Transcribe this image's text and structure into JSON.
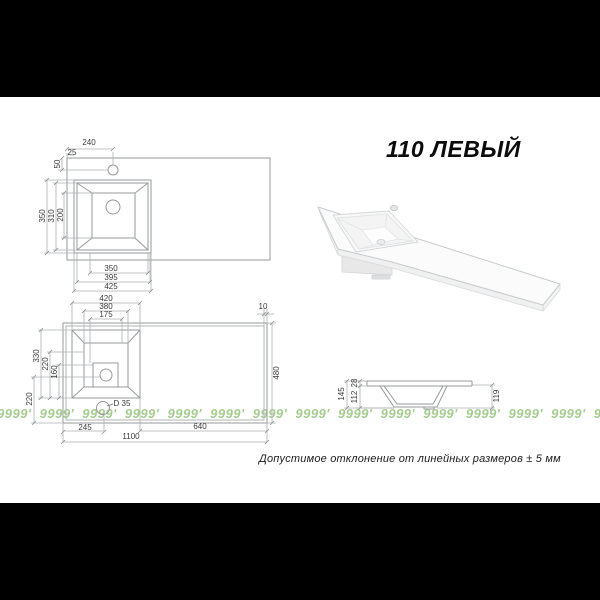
{
  "title": "110 ЛЕВЫЙ",
  "note": "Допустимое отклонение от линейных размеров ± 5 мм",
  "watermark": {
    "text": "9999' 9999' 9999' 9999' 9999' 9999' 9999' 9999' 9999' 9999' 9999' 9999' 9999' 9999' 9999' 9999' 9999' 9999'",
    "color": "#a5cc90"
  },
  "colors": {
    "background_bars": "#000000",
    "canvas": "#ffffff",
    "drawing_line": "#97999b",
    "dimension_text": "#3a3a3a"
  },
  "top_view": {
    "dims": {
      "d240": "240",
      "d25": "25",
      "d50": "50",
      "d350": "350",
      "d310": "310",
      "d200": "200",
      "db350": "350",
      "db395": "395",
      "db425": "425"
    }
  },
  "bottom_view": {
    "dims": {
      "d420": "420",
      "d380": "380",
      "d175": "175",
      "d10": "10",
      "d330": "330",
      "d220": "220",
      "d160": "160",
      "d220b": "220",
      "d480": "480",
      "d245": "245",
      "d640": "640",
      "d1100": "1100",
      "dD35": "D 35"
    }
  },
  "section_view": {
    "dims": {
      "d145": "145",
      "d28": "28",
      "d112": "112",
      "d119": "119"
    }
  }
}
